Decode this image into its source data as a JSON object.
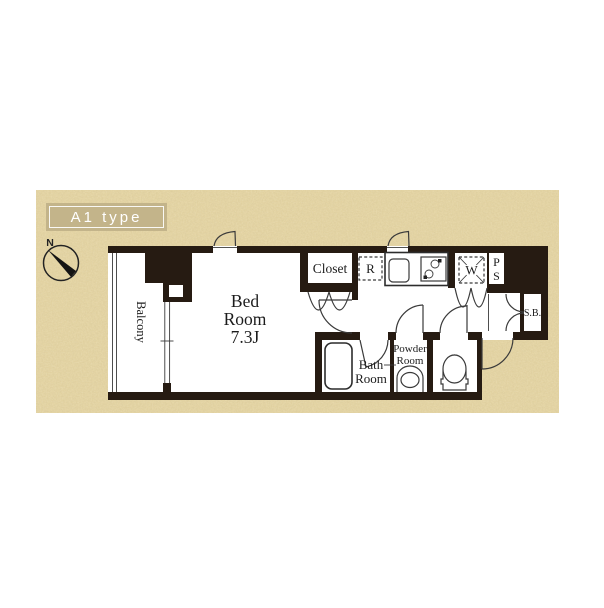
{
  "header": {
    "type_label": "A1 type"
  },
  "compass": {
    "north": "N"
  },
  "rooms": {
    "balcony": {
      "label": "Balcony"
    },
    "bedroom": {
      "lines": [
        "Bed",
        "Room",
        "7.3J"
      ]
    },
    "closet": {
      "label": "Closet"
    },
    "bath": {
      "lines": [
        "Bath",
        "Room"
      ]
    },
    "powder": {
      "lines": [
        "Powder",
        "Room"
      ]
    }
  },
  "fixtures": {
    "refrigerator": {
      "label": "R"
    },
    "washer": {
      "label": "W"
    },
    "pipe_space": {
      "lines": [
        "P",
        "S"
      ]
    },
    "shoe_box": {
      "label": "S.B."
    }
  },
  "colors": {
    "wall": "#261b12",
    "line": "#3a3a3a",
    "paper": "#e4d4a3",
    "label_bg": "#c3b48a",
    "label_text": "#ffffff",
    "ink": "#1c1c1c"
  }
}
